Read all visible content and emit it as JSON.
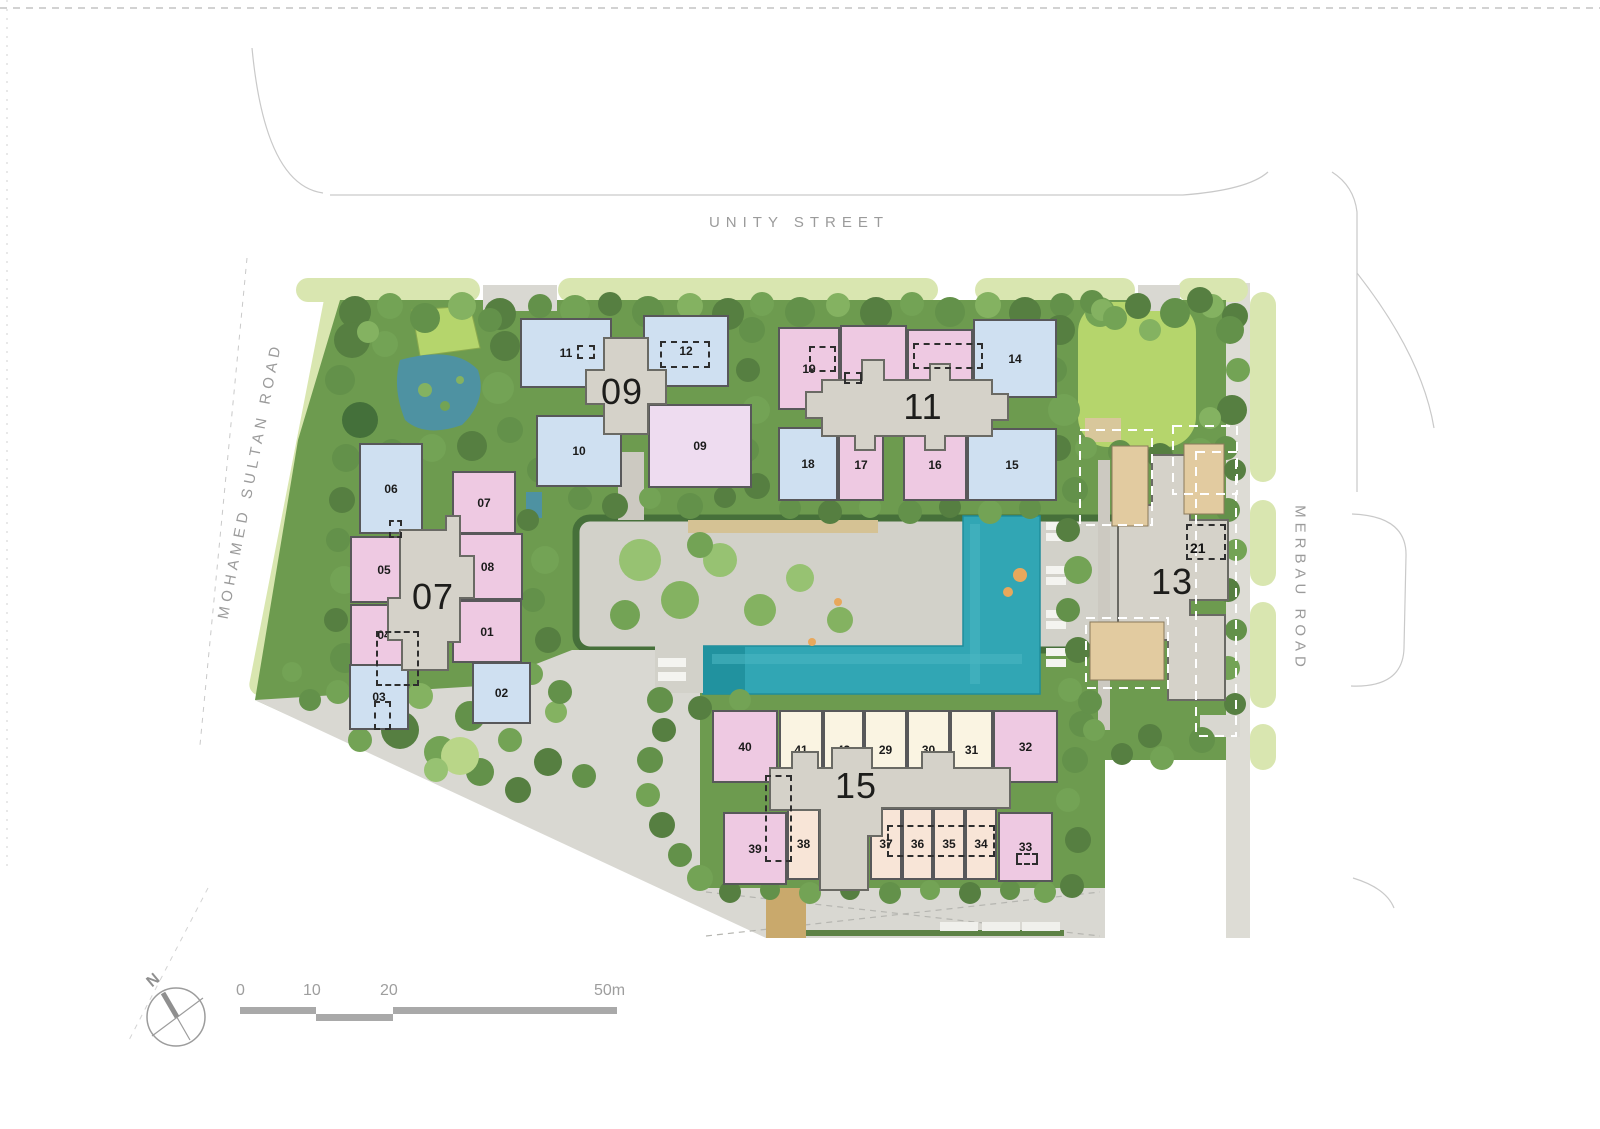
{
  "streets": {
    "top": "UNITY STREET",
    "left": "MOHAMED SULTAN ROAD",
    "right": "MERBAU ROAD"
  },
  "compass": {
    "north": "N"
  },
  "scale": {
    "t0": "0",
    "t10": "10",
    "t20": "20",
    "t50": "50m"
  },
  "buildings": {
    "b07": {
      "label": "07",
      "units": {
        "u01": "01",
        "u02": "02",
        "u03": "03",
        "u04": "04",
        "u05": "05",
        "u06": "06",
        "u07": "07",
        "u08": "08"
      }
    },
    "b09": {
      "label": "09",
      "units": {
        "u09": "09",
        "u10": "10",
        "u11": "11",
        "u12": "12"
      }
    },
    "b11": {
      "label": "11",
      "units": {
        "u13": "13",
        "u14": "14",
        "u15": "15",
        "u16": "16",
        "u17": "17",
        "u18": "18",
        "u19": "19",
        "u20": "20"
      }
    },
    "b13": {
      "label": "13",
      "units": {
        "u21": "21"
      }
    },
    "b15": {
      "label": "15",
      "units": {
        "u29": "29",
        "u30": "30",
        "u31": "31",
        "u32": "32",
        "u33": "33",
        "u34": "34",
        "u35": "35",
        "u36": "36",
        "u37": "37",
        "u38": "38",
        "u39": "39",
        "u40": "40",
        "u41": "41",
        "u42": "42"
      }
    }
  },
  "palette": {
    "unit_pink": "#eec9e2",
    "unit_blue": "#cfe0f1",
    "unit_lavender": "#eedcf0",
    "unit_cream": "#faf4e2",
    "unit_peach": "#f8e5d7",
    "core_gray": "#d5d2c9",
    "pool_teal": "#31a6b4",
    "greenery": "#6d9b4f",
    "lawn": "#b5d56c",
    "verge": "#d9e6b0",
    "paving": "#d9d8d2",
    "deck_tan": "#e2cba0",
    "road_text": "#9b9b9b"
  }
}
